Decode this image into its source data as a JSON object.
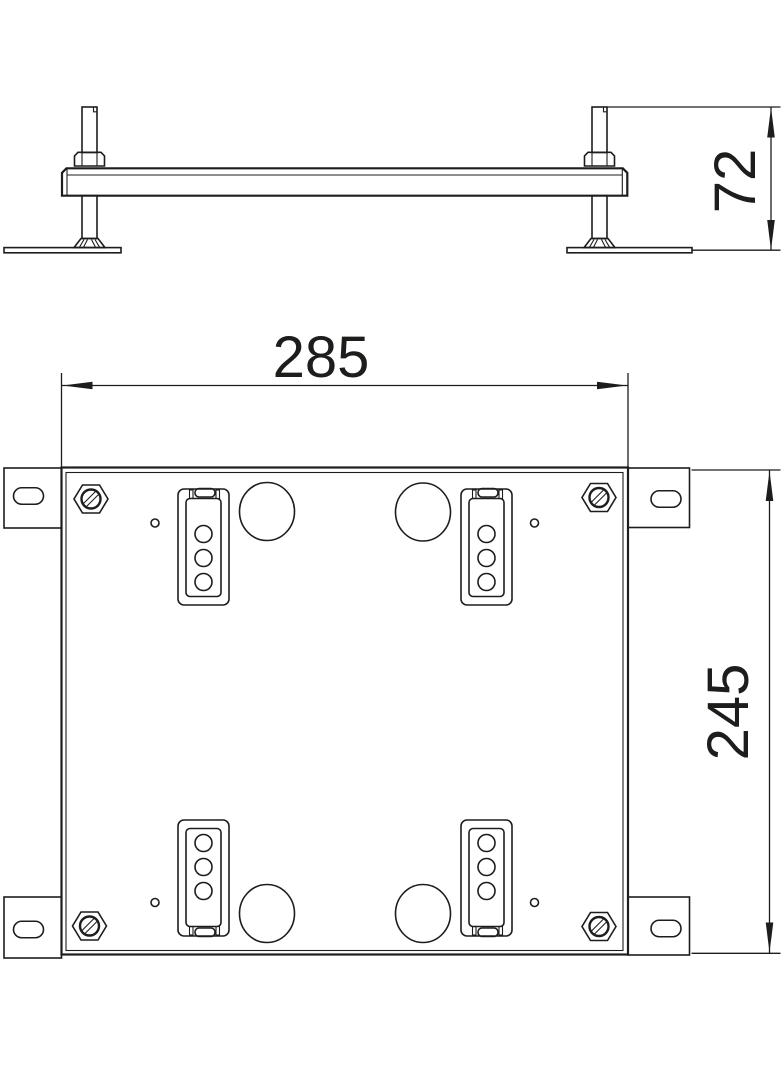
{
  "drawing": {
    "dimension_labels": {
      "width": "285",
      "depth": "245",
      "height": "72"
    },
    "colors": {
      "line": "#1d1d1b",
      "background": "#ffffff"
    }
  }
}
